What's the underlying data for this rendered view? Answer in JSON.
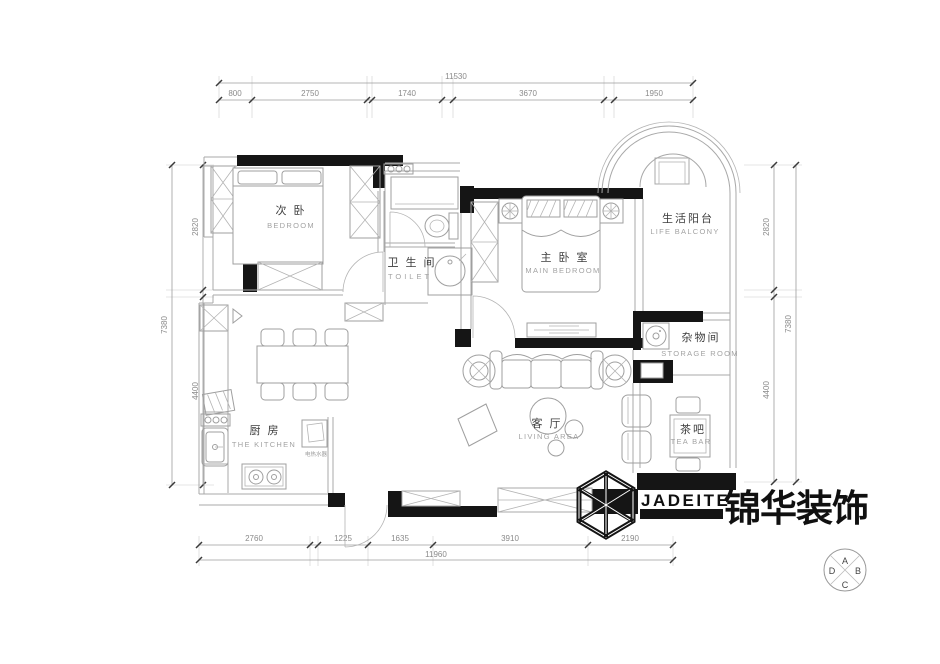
{
  "dims": {
    "top": {
      "total": "11530",
      "segments": [
        "800",
        "2750",
        "1740",
        "3670",
        "1950"
      ]
    },
    "bottom": {
      "total": "11960",
      "segments": [
        "2760",
        "1225",
        "1635",
        "3910",
        "2190"
      ]
    },
    "left": {
      "total": "7380",
      "segments": [
        "2820",
        "4400"
      ]
    },
    "right": {
      "total": "7380",
      "segments": [
        "2820",
        "4400"
      ]
    }
  },
  "rooms": {
    "bedroom2": {
      "zh": "次 卧",
      "en": "BEDROOM"
    },
    "toilet": {
      "zh": "卫 生 间",
      "en": "TOILET"
    },
    "main_bedroom": {
      "zh": "主 卧 室",
      "en": "MAIN BEDROOM"
    },
    "balcony": {
      "zh": "生活阳台",
      "en": "LIFE BALCONY"
    },
    "storage": {
      "zh": "杂物间",
      "en": "STORAGE ROOM"
    },
    "kitchen": {
      "zh": "厨 房",
      "en": "THE KITCHEN"
    },
    "living": {
      "zh": "客 厅",
      "en": "LIVING AREA"
    },
    "teabar": {
      "zh": "茶吧",
      "en": "TEA BAR"
    }
  },
  "annotations": {
    "water_heater": "电热水器"
  },
  "branding": {
    "logo_en": "JADEITE",
    "logo_zh": "锦华装饰"
  },
  "compass": {
    "n": "A",
    "e": "B",
    "s": "C",
    "w": "D"
  },
  "colors": {
    "wall": "#151515",
    "line": "#a8a8a8",
    "dim_text": "#8a8a8a",
    "ink": "#101010"
  }
}
